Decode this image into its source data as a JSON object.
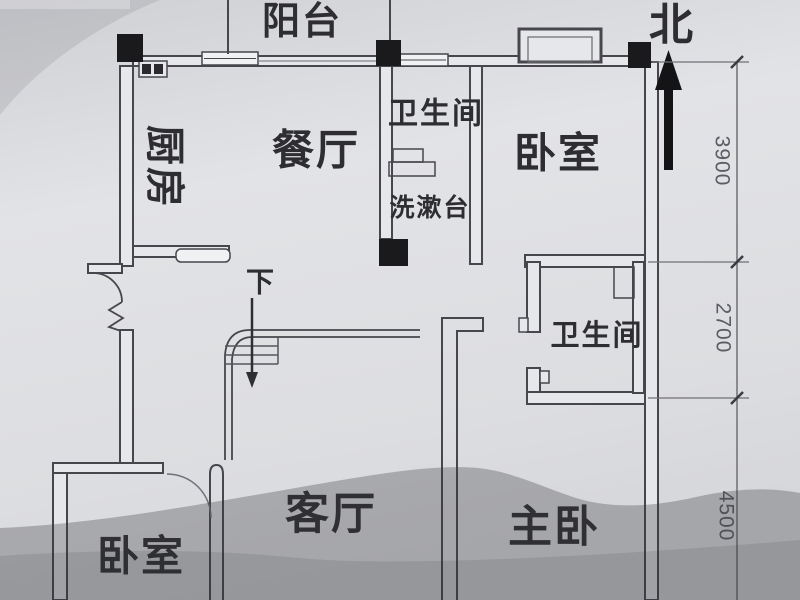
{
  "title": "apartment-floor-plan-photo",
  "labels": {
    "balcony": "阳台",
    "north": "北",
    "kitchen": "厨房",
    "dining": "餐厅",
    "bathroom_top": "卫生间",
    "washstand": "洗漱台",
    "bedroom_right": "卧室",
    "bathroom_right": "卫生间",
    "bedroom_left": "卧室",
    "living_room": "客厅",
    "master_bedroom": "主卧",
    "stairs_down": "下"
  },
  "dimensions": [
    "3900",
    "2700",
    "4500"
  ],
  "colors": {
    "paper": "#dcdde0",
    "wall_ink": "#46464c",
    "column_fill": "#1a1a1c",
    "dim_ink": "#5c5c64",
    "shadow": "#34363c"
  }
}
